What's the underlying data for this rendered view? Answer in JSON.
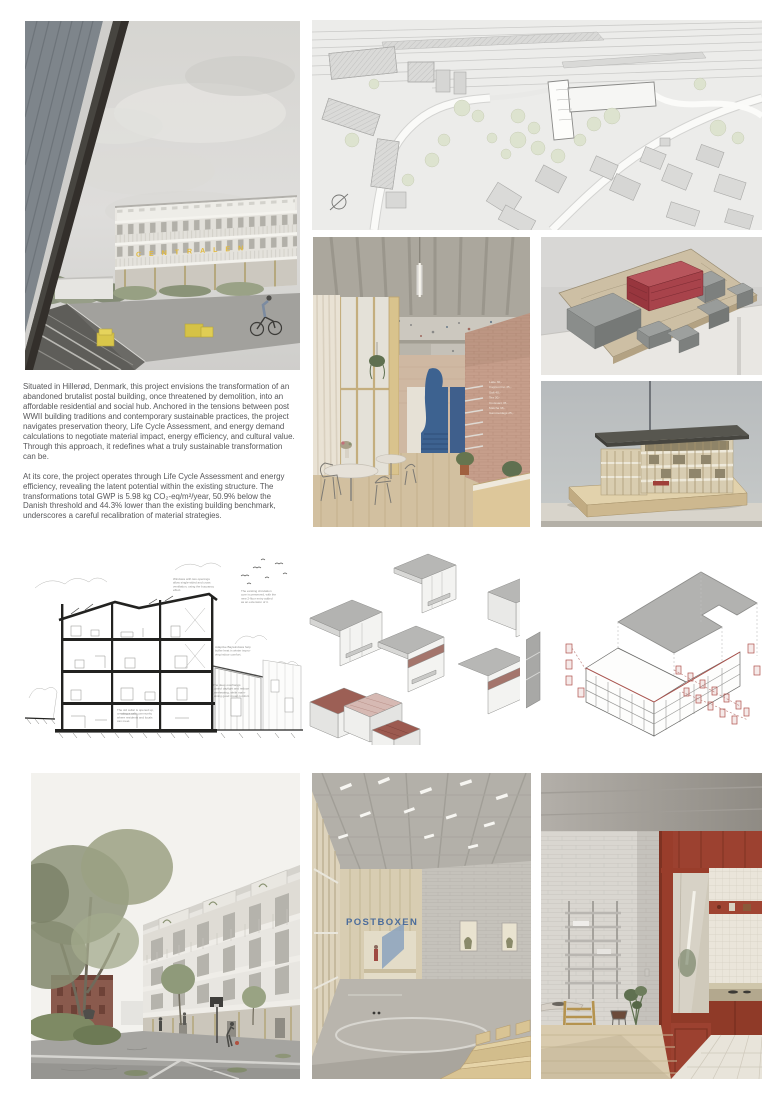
{
  "hero": {
    "sign": "CENTRALEN",
    "sign_color": "#e2b93b"
  },
  "intro": {
    "p1": "Situated in Hillerød, Denmark, this project envisions the transformation of an abandoned brutalist postal building, once threatened by demolition, into an affordable residential and social hub. Anchored in the tensions between post WWII building traditions and contemporary sustainable practices, the project navigates preservation theory, Life Cycle Assessment, and energy demand calculations to negotiate material impact, energy efficiency, and cultural value. Through this approach, it redefines what a truly sustainable transformation can be.",
    "p2": "At its core, the project operates through Life Cycle Assessment and energy efficiency, revealing the latent potential within the existing structure. The transformations total GWP is 5.98 kg CO₂-eq/m²/year, 50.9% below the Danish threshold and 44.3% lower than the existing building benchmark, underscores a careful recalibration of material strategies."
  },
  "section": {
    "annotations": [
      {
        "lines": [
          "Windows with two openings",
          "allow single-sided and cross",
          "ventilation, using the buoyancy",
          "effect."
        ]
      },
      {
        "lines": [
          "The existing circulation",
          "core is preserved, with the",
          "new 2-floor entry added",
          "as an extension of it."
        ]
      },
      {
        "lines": [
          "Adaptive Baywindows help",
          "buffer heat in winter impro-",
          "ving indoor comfort."
        ]
      },
      {
        "lines": [
          "The deep overhangs",
          "control daylight and reduce",
          "overheating, while main-",
          "taining good visual comfort."
        ]
      },
      {
        "lines": [
          "The old cellar is opened up,",
          "creating a café community",
          "where residents and locals",
          "can meet."
        ]
      }
    ]
  },
  "cafe": {
    "menu": [
      "Latte 30,-",
      "Cappuccino 35,-",
      "Saft 40,-",
      "Tea 30,-",
      "Croissant 45,-",
      "Matcha 38,-",
      "Gammeldags 25,-"
    ]
  },
  "hall": {
    "sign": "POSTBOXEN",
    "sign_color": "#4c6d9b"
  },
  "colors": {
    "accent_red": "#a23e46",
    "stair_blue": "#3d6290"
  }
}
